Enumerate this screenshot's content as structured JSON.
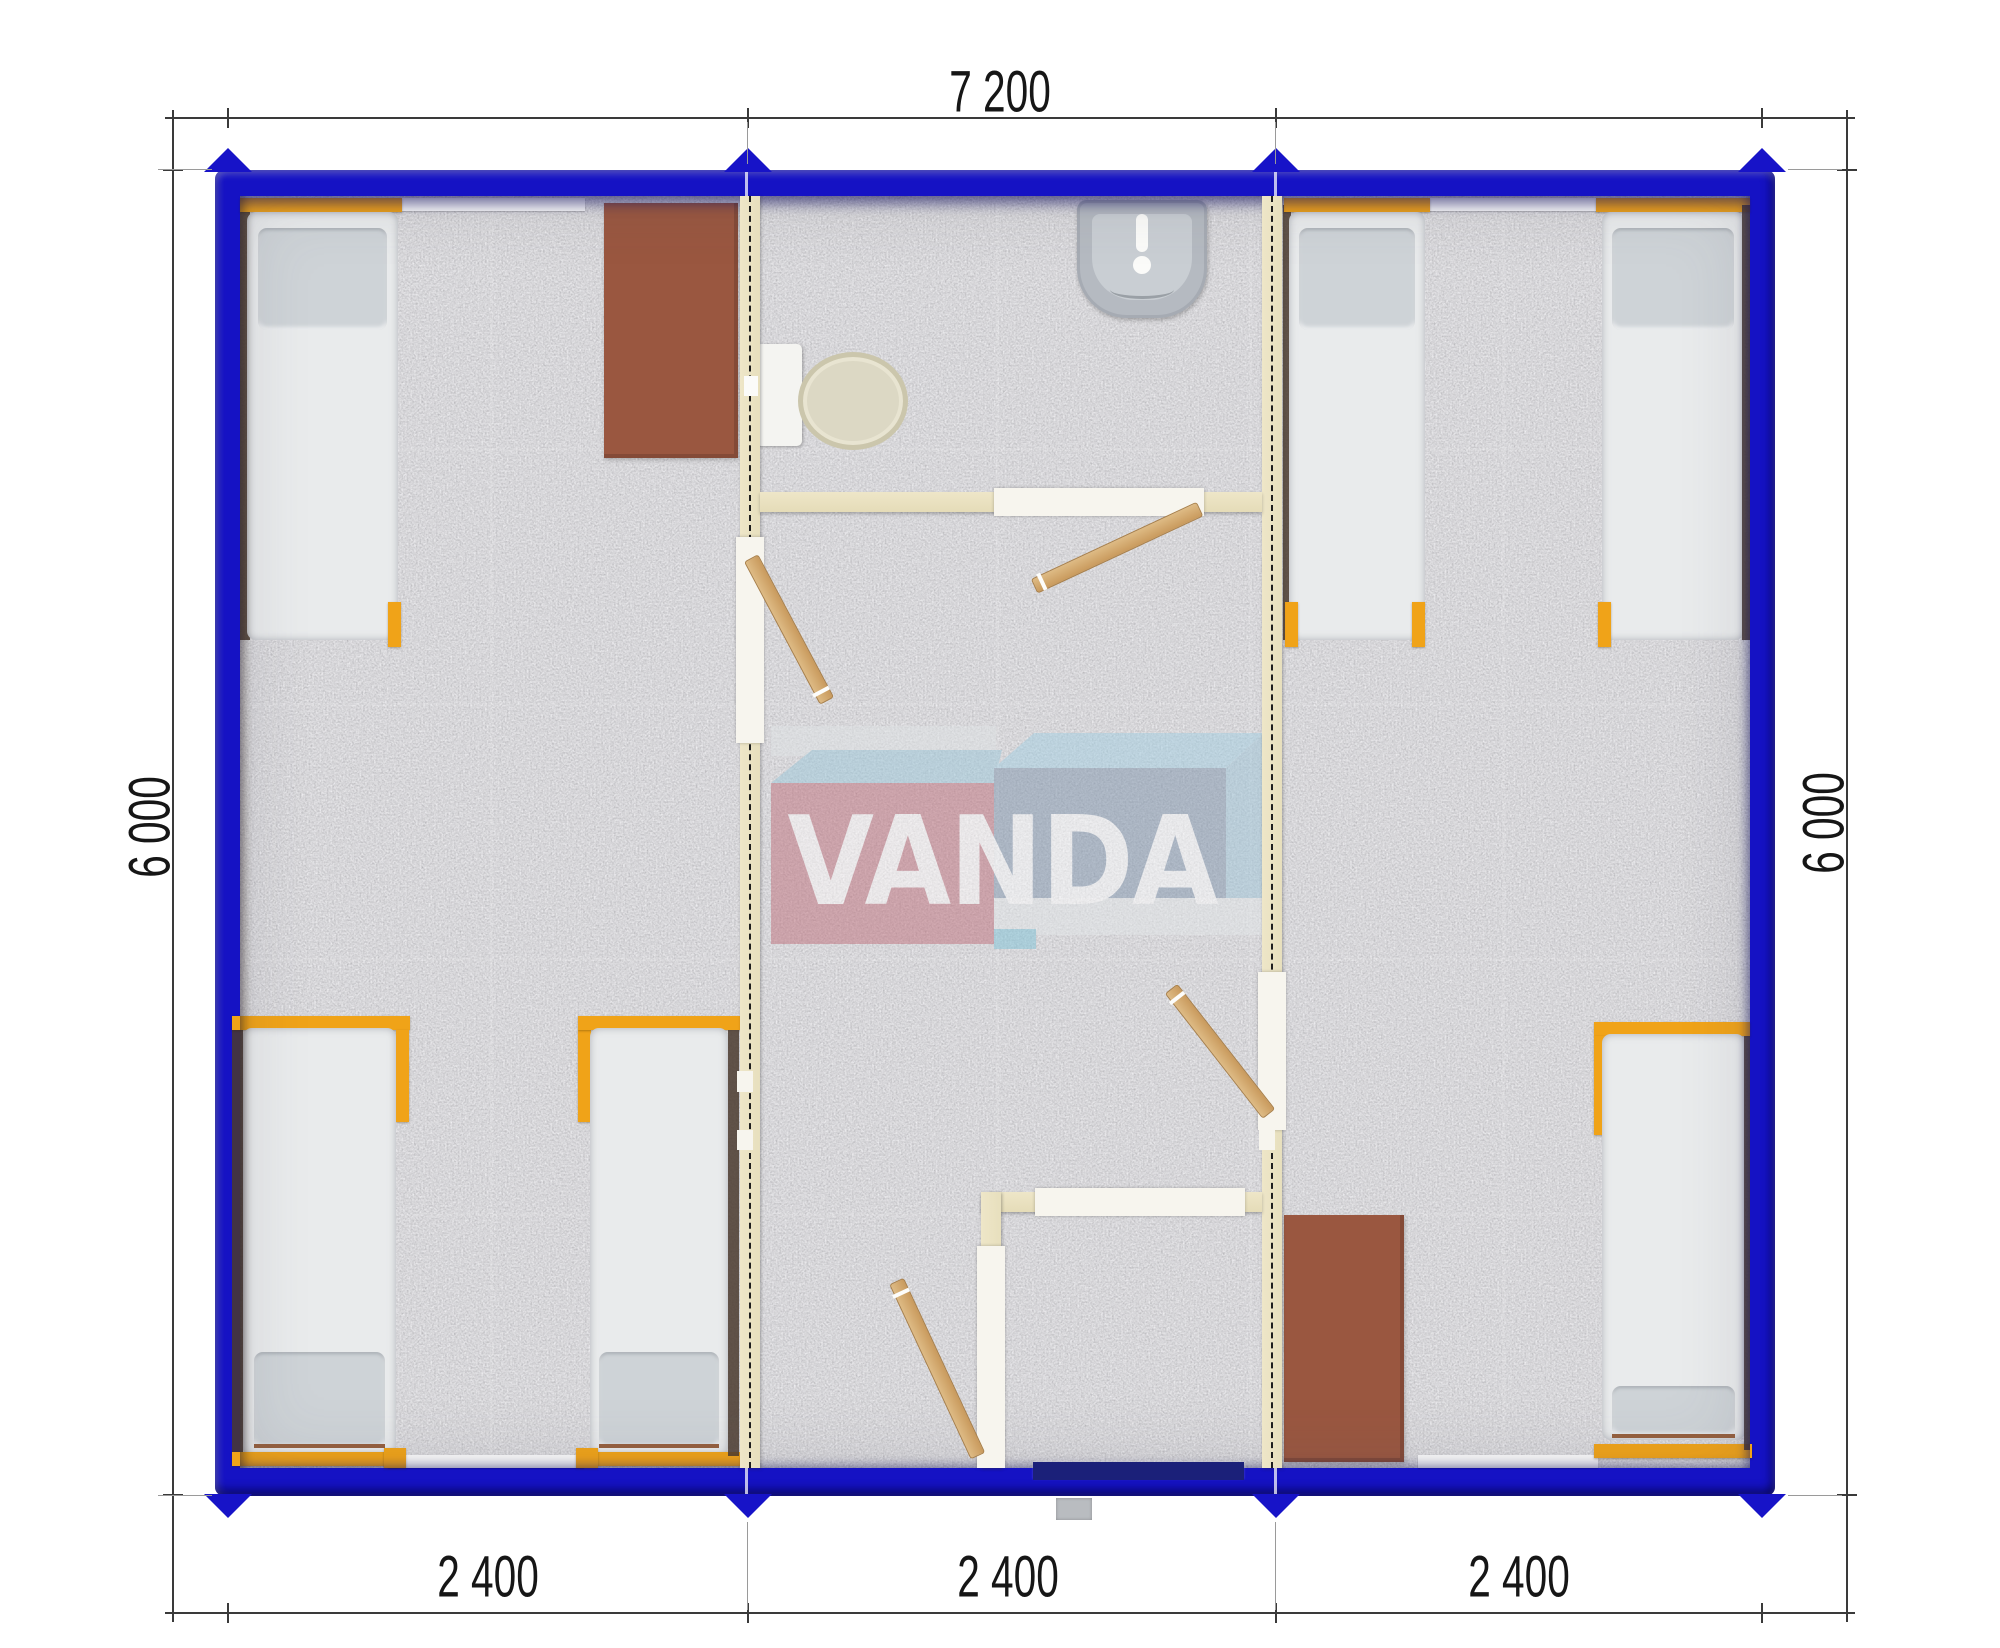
{
  "watermark": {
    "brand": "VANDA"
  },
  "dimensions": {
    "top": {
      "label": "7 200"
    },
    "left": {
      "label": "6 000"
    },
    "right": {
      "label": "6 000"
    },
    "bottom": [
      {
        "label": "2 400"
      },
      {
        "label": "2 400"
      },
      {
        "label": "2 400"
      }
    ]
  },
  "plan": {
    "type": "modular-container-house-floor-plan",
    "modules": 3,
    "rooms": [
      {
        "name": "bedroom-left",
        "beds": 3,
        "desks": 1
      },
      {
        "name": "entry-hall-with-sanitary",
        "fixtures": [
          "toilet",
          "wash-basin"
        ],
        "doors": 4
      },
      {
        "name": "bedroom-right",
        "beds": 3,
        "desks": 1
      }
    ]
  },
  "colors": {
    "container_blue": "#1512c4",
    "partition_cream": "#ebe3c4",
    "bed_frame_orange": "#f0a318",
    "door_wood": "#d2a36b",
    "desk_brown": "#9a5740",
    "carpet_gray": "#a8a7ad",
    "dimension_text": "#161616"
  }
}
